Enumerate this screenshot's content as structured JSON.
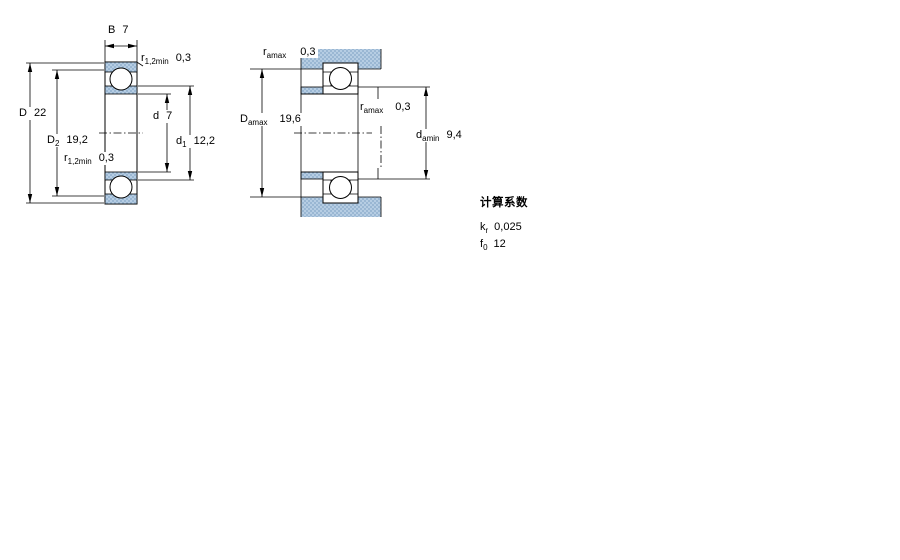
{
  "colors": {
    "hatch_fill": "#b6cde3",
    "hatch_dot": "#86a8c8",
    "line": "#000000",
    "background": "#ffffff"
  },
  "diagram_left": {
    "dims": {
      "B": {
        "label": "B",
        "value": "7"
      },
      "r_top": {
        "label": "r",
        "sub": "1,2min",
        "value": "0,3"
      },
      "D": {
        "label": "D",
        "value": "22"
      },
      "D2": {
        "label": "D",
        "sub": "2",
        "value": "19,2"
      },
      "d": {
        "label": "d",
        "value": "7"
      },
      "d1": {
        "label": "d",
        "sub": "1",
        "value": "12,2"
      },
      "r_bottom": {
        "label": "r",
        "sub": "1,2min",
        "value": "0,3"
      }
    }
  },
  "diagram_right": {
    "dims": {
      "ra_top": {
        "label": "r",
        "sub": "amax",
        "value": "0,3"
      },
      "Da": {
        "label": "D",
        "sub": "amax",
        "value": "19,6"
      },
      "ra_mid": {
        "label": "r",
        "sub": "amax",
        "value": "0,3"
      },
      "da": {
        "label": "d",
        "sub": "amin",
        "value": "9,4"
      }
    }
  },
  "calculation_factors": {
    "title": "计算系数",
    "rows": [
      {
        "label": "k",
        "sub": "r",
        "value": "0,025"
      },
      {
        "label": "f",
        "sub": "0",
        "value": "12"
      }
    ]
  }
}
